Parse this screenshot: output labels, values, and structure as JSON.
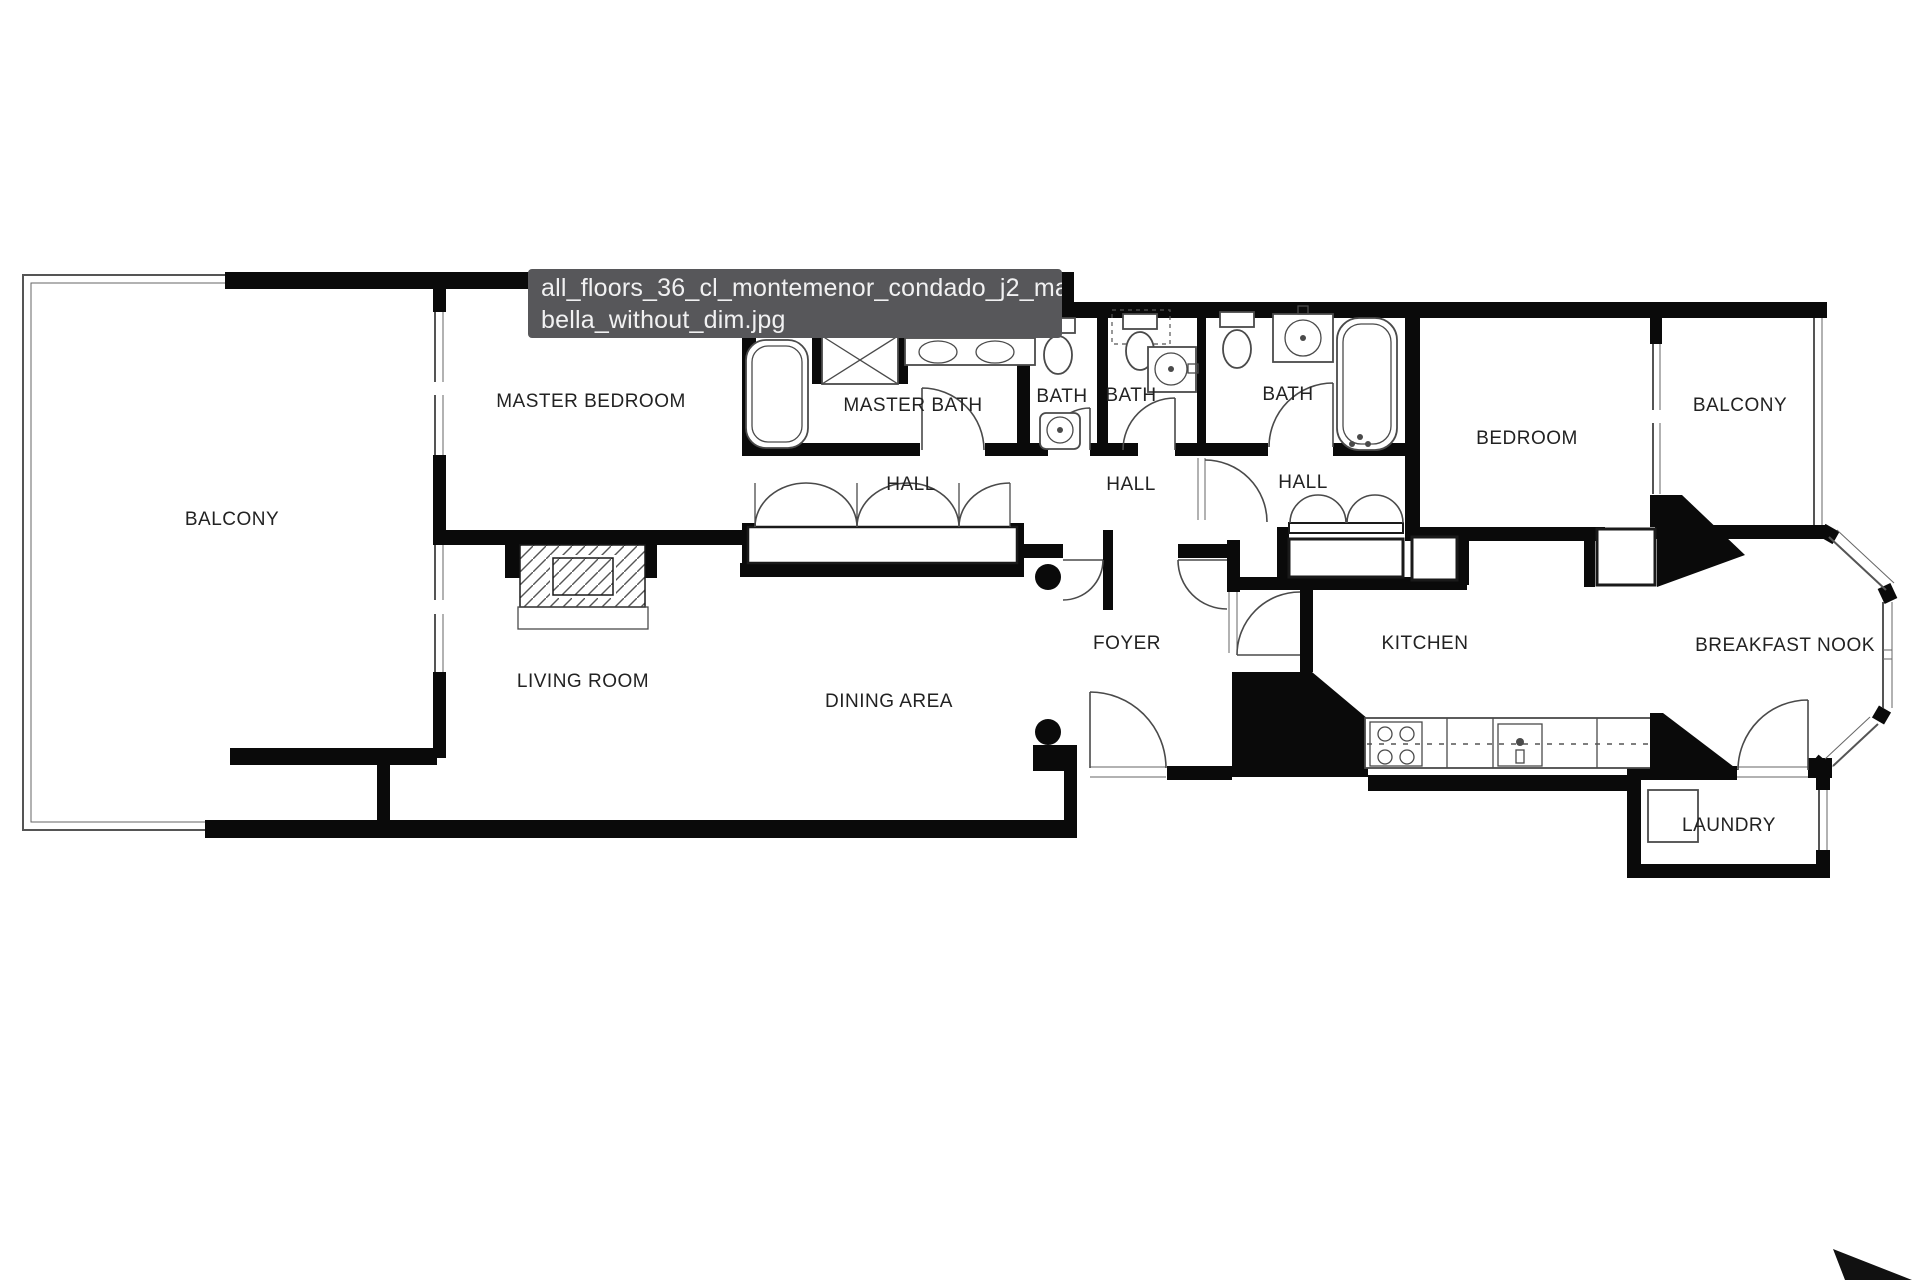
{
  "tooltip": {
    "filename_line1": "all_floors_36_cl_montemenor_condado_j2_mar",
    "filename_line2": "bella_without_dim.jpg",
    "background": "#57575a",
    "text_color": "#f1f1f2"
  },
  "floor_plan": {
    "rooms": [
      {
        "id": "balcony-left",
        "label": "BALCONY"
      },
      {
        "id": "master-bedroom",
        "label": "MASTER BEDROOM"
      },
      {
        "id": "master-bath",
        "label": "MASTER BATH"
      },
      {
        "id": "bath-1",
        "label": "BATH"
      },
      {
        "id": "bath-2",
        "label": "BATH"
      },
      {
        "id": "bath-3",
        "label": "BATH"
      },
      {
        "id": "hall-1",
        "label": "HALL"
      },
      {
        "id": "hall-2",
        "label": "HALL"
      },
      {
        "id": "hall-3",
        "label": "HALL"
      },
      {
        "id": "bedroom",
        "label": "BEDROOM"
      },
      {
        "id": "balcony-right",
        "label": "BALCONY"
      },
      {
        "id": "foyer",
        "label": "FOYER"
      },
      {
        "id": "kitchen",
        "label": "KITCHEN"
      },
      {
        "id": "breakfast-nook",
        "label": "BREAKFAST NOOK"
      },
      {
        "id": "living-room",
        "label": "LIVING ROOM"
      },
      {
        "id": "dining-area",
        "label": "DINING AREA"
      },
      {
        "id": "laundry",
        "label": "LAUNDRY"
      }
    ]
  },
  "colors": {
    "wall": "#0a0a0a",
    "thin_line": "#555555",
    "label": "#222222",
    "tooltip_background": "#57575a",
    "cursor": "#111111",
    "background": "#ffffff"
  }
}
